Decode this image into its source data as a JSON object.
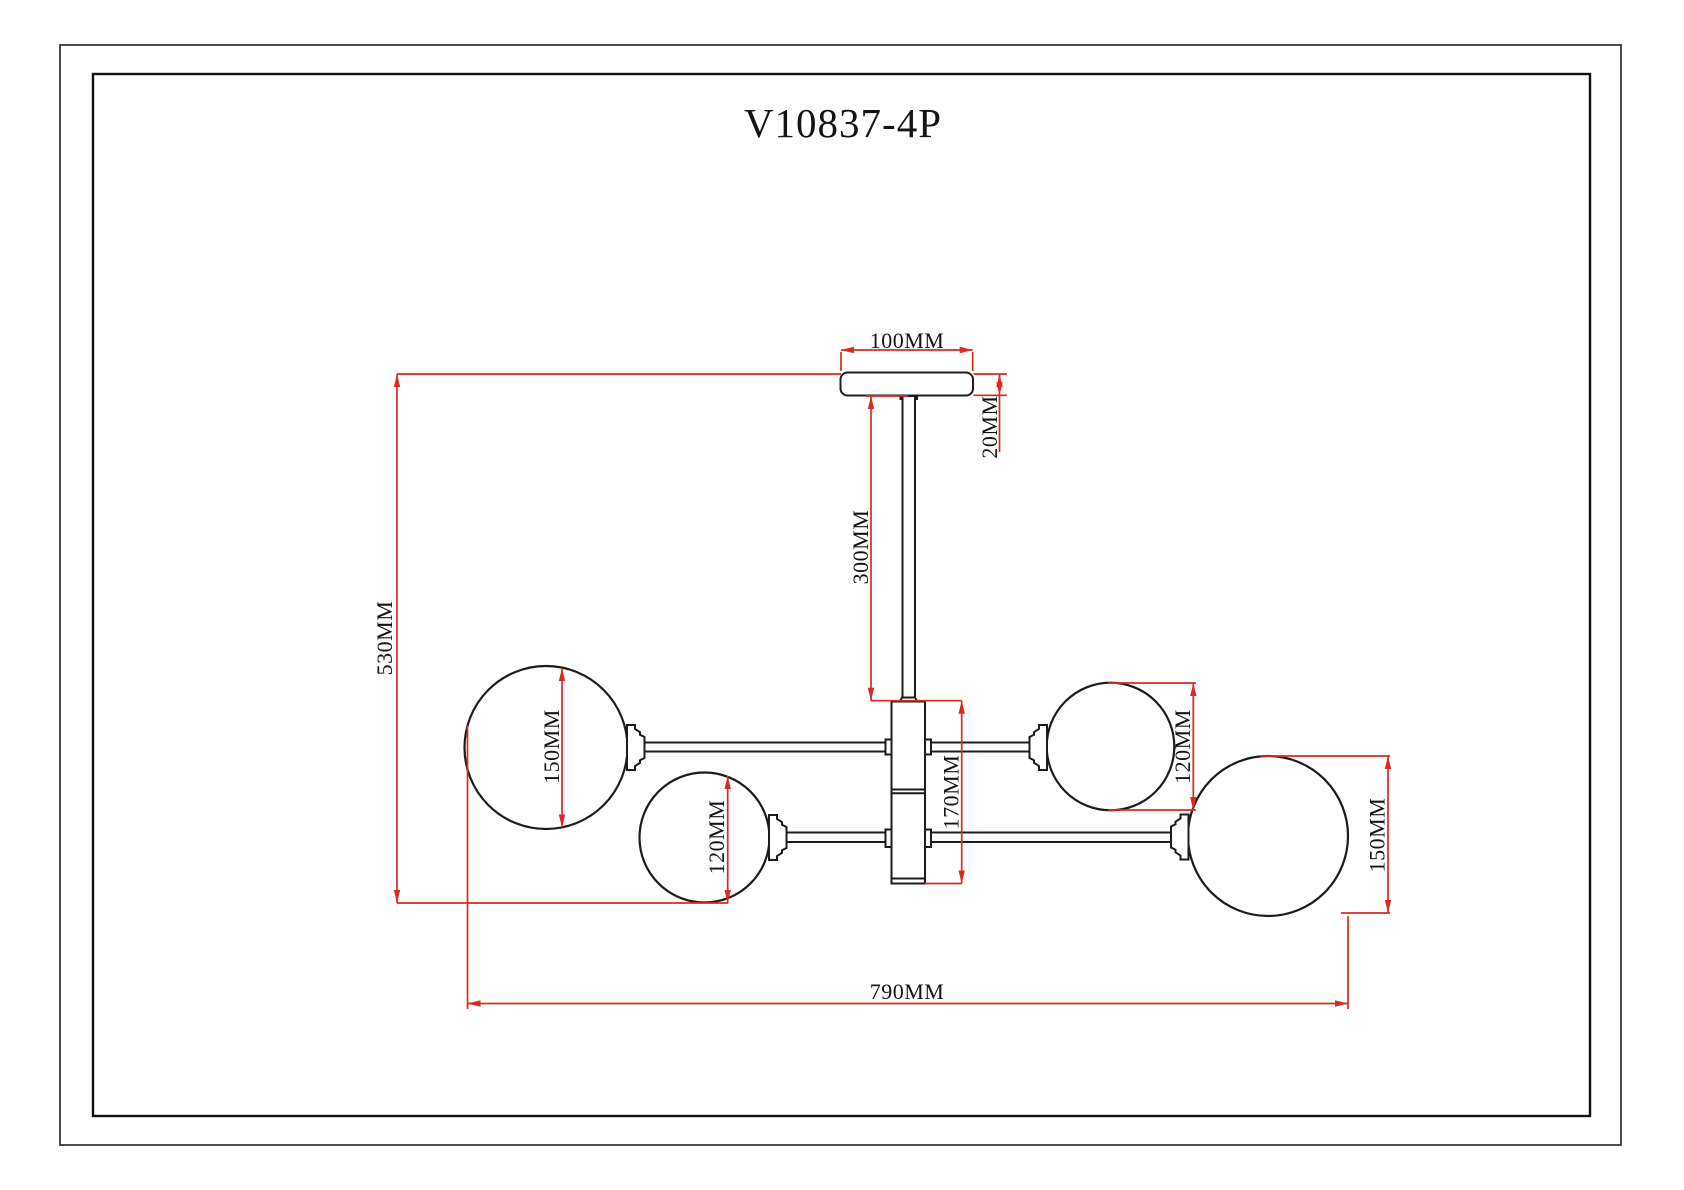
{
  "title": "V10837-4P",
  "colors": {
    "drawing_line": "#1c1c1c",
    "dimension_line": "#d92b1f",
    "background": "#ffffff"
  },
  "labels": {
    "canopy_width": "100MM",
    "canopy_height": "20MM",
    "rod_length": "300MM",
    "overall_height": "530MM",
    "left_globe_diameter": "150MM",
    "lower_left_globe_diameter": "120MM",
    "center_body_height": "170MM",
    "right_globe_diameter": "120MM",
    "far_right_globe_diameter": "150MM",
    "overall_width": "790MM"
  }
}
